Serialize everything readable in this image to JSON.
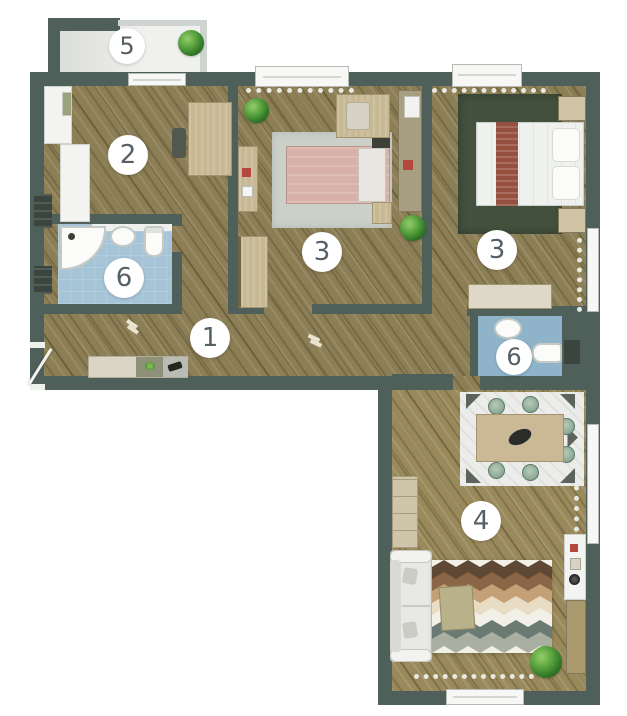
{
  "room_labels": {
    "hallway": "1",
    "bedroom_left": "2",
    "bedroom_middle": "3",
    "bedroom_right": "3",
    "living_room": "4",
    "balcony": "5",
    "bathroom_left": "6",
    "bathroom_right": "6"
  },
  "palette": {
    "wall": "#4f605a",
    "wood": "#8c7e55",
    "balcony_floor": "#e6e8e4",
    "bathroom_floor": "#a6c4d7",
    "bathroom_floor_right": "#8fb4c9",
    "rug_dark_green": "#43513e",
    "rug_light_gray": "#cbd0c9",
    "bed_pink": "#d8b2a9",
    "bed_runner_red": "#95503f",
    "furniture_beige": "#c8b995",
    "furniture_khaki": "#a89e82",
    "sofa_gray": "#e8e9e5",
    "plant_green": "#4e9a3a",
    "badge_text": "#555f66"
  },
  "rug_chevron_colors": [
    "#5e4733",
    "#8a6546",
    "#c3a076",
    "#e8dcc4",
    "#f2efe6",
    "#6b7a72",
    "#a9b0a2"
  ]
}
